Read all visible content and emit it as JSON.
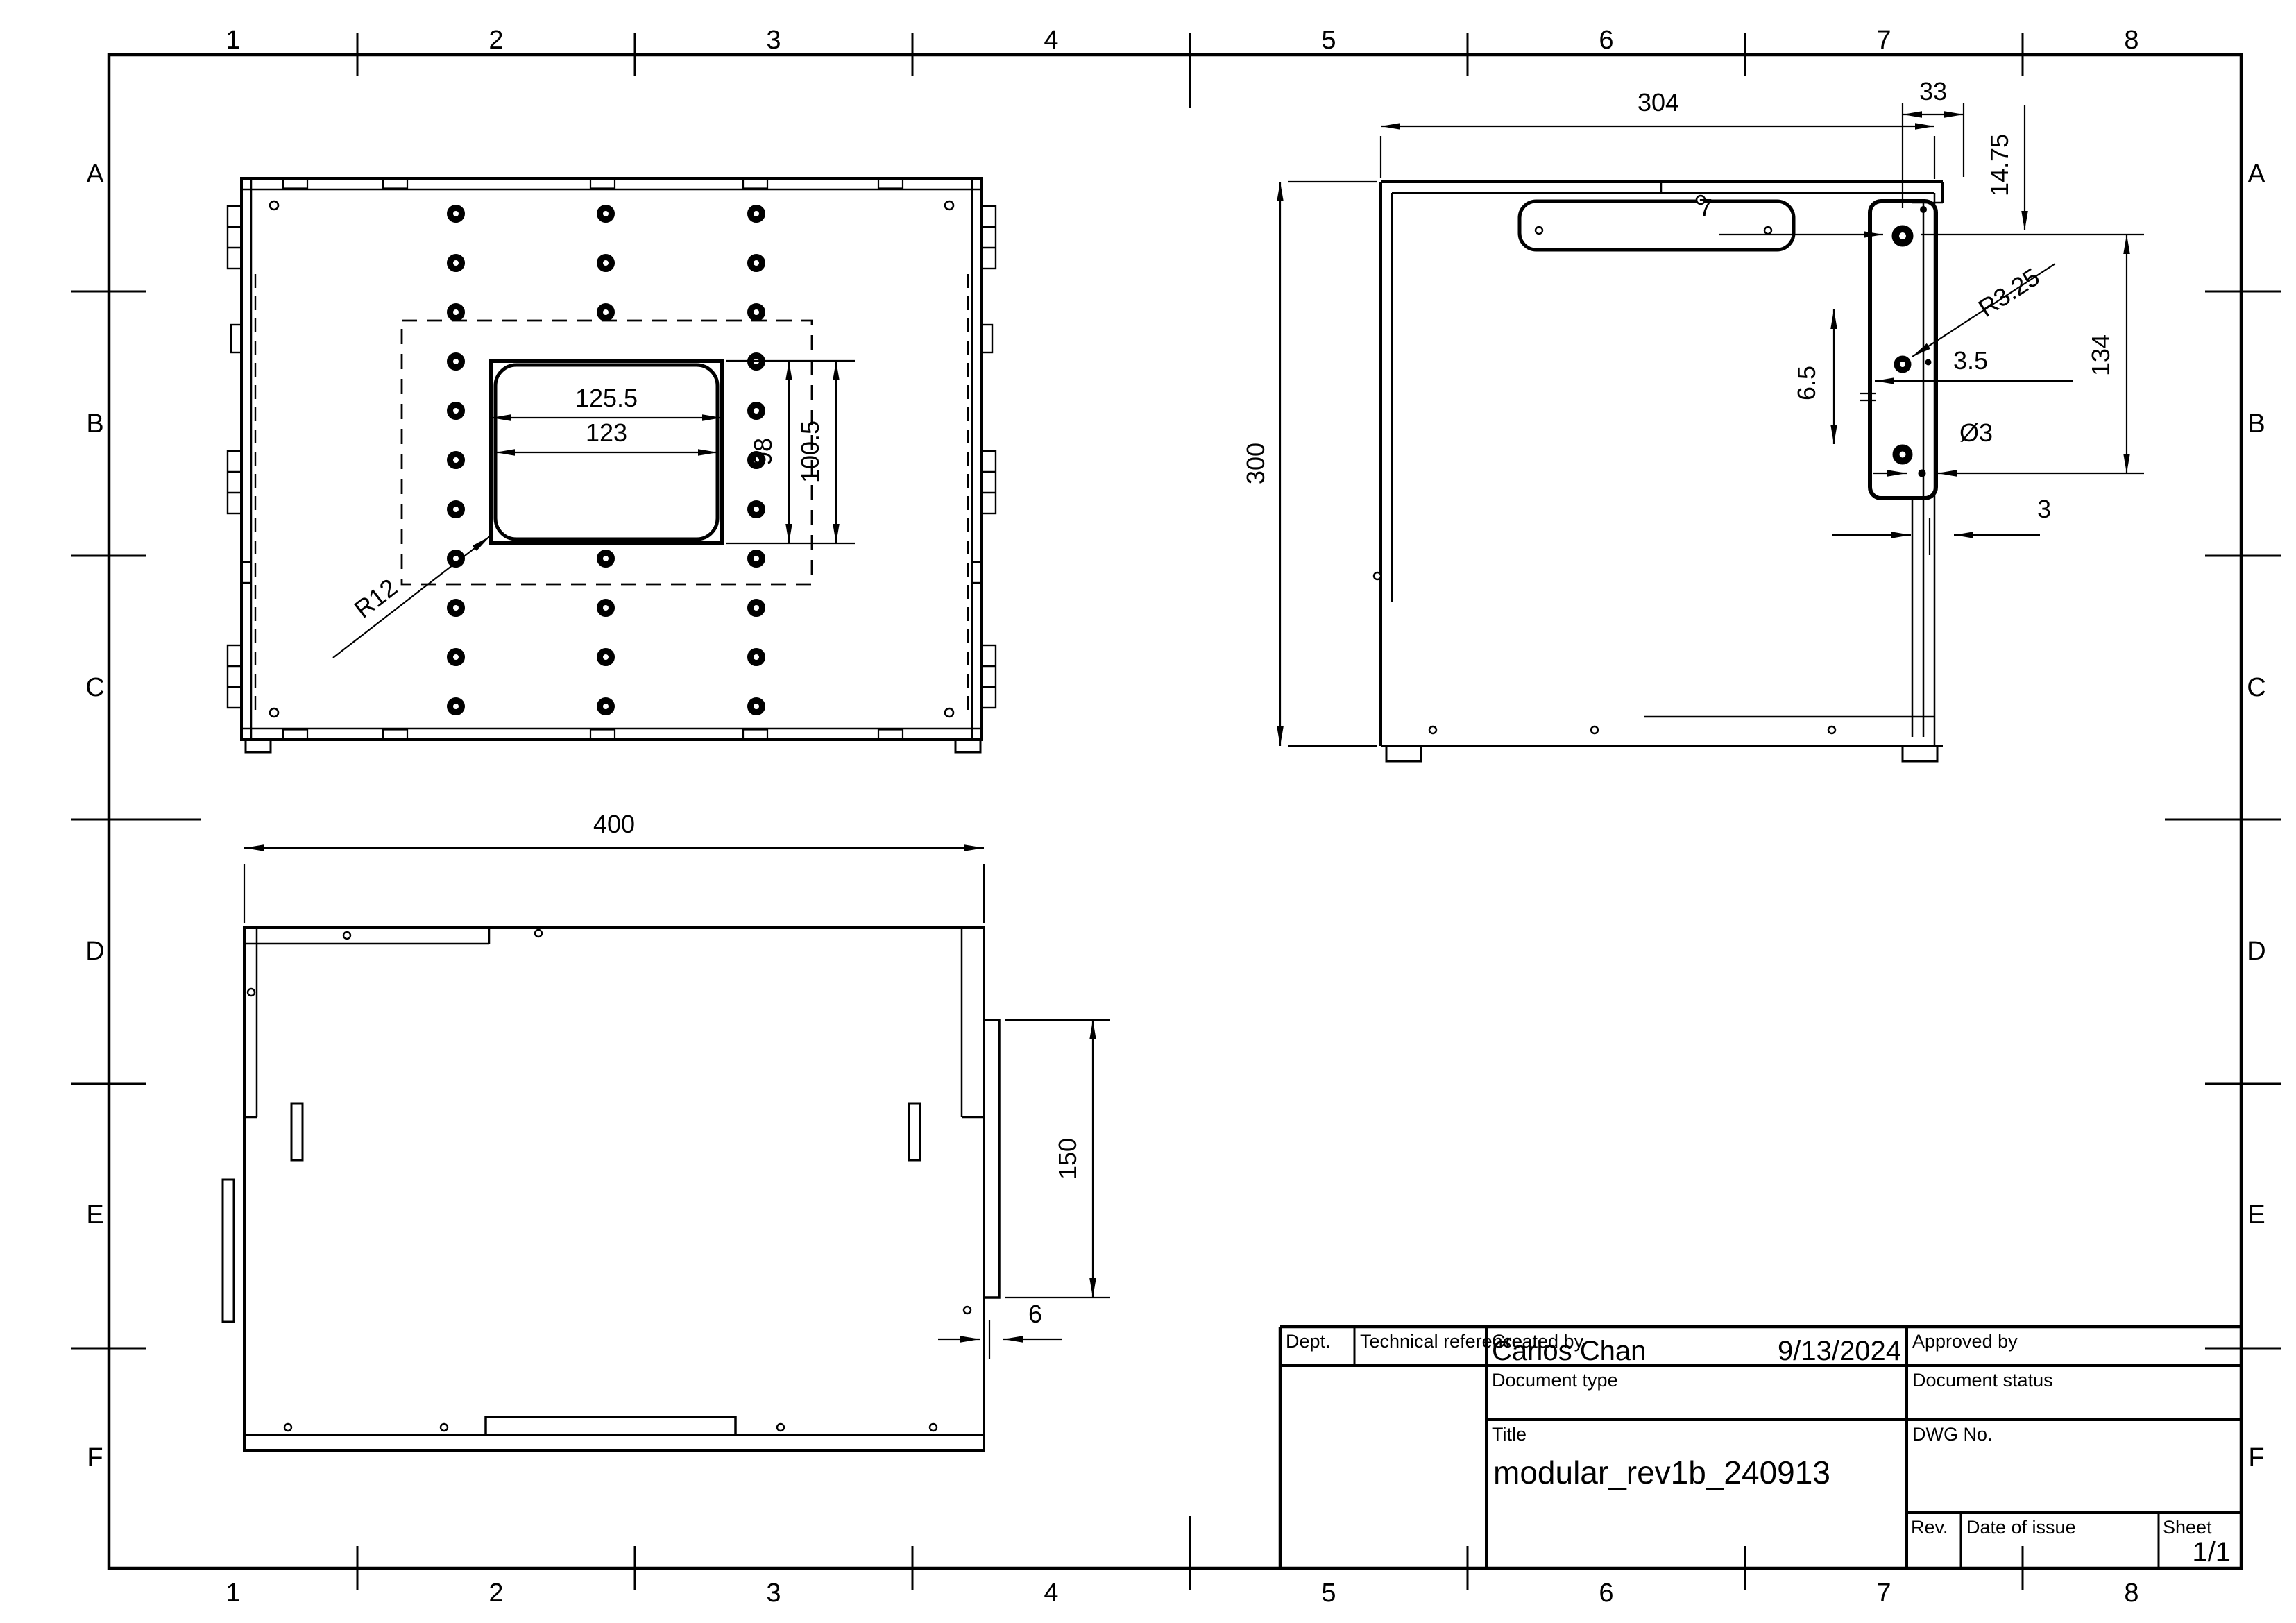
{
  "sheet": {
    "background": "#ffffff",
    "line_color": "#000000",
    "grid_columns": [
      "1",
      "2",
      "3",
      "4",
      "5",
      "6",
      "7",
      "8"
    ],
    "grid_rows": [
      "A",
      "B",
      "C",
      "D",
      "E",
      "F"
    ]
  },
  "top_view": {
    "dim_width_outer": "125.5",
    "dim_width_inner": "123",
    "dim_height_inner": "98",
    "dim_height_outer": "100.5",
    "dim_corner_radius": "R12"
  },
  "side_view": {
    "dim_width": "304",
    "dim_height": "300",
    "dim_tab_width": "33",
    "dim_top_offset": "14.75",
    "dim_hole_offset": "7",
    "dim_slot_radius": "R3.25",
    "dim_hole_gap": "3.5",
    "dim_hole_pitch": "6.5",
    "dim_hole_dia": "Ø3",
    "dim_wall_thickness": "3",
    "dim_bracket_span": "134"
  },
  "bottom_view": {
    "dim_width": "400",
    "dim_flange_height": "150",
    "dim_wall_thickness": "6"
  },
  "title_block": {
    "dept_label": "Dept.",
    "tech_ref_label": "Technical reference",
    "created_by_label": "Created by",
    "created_by_name": "Carlos Chan",
    "created_date": "9/13/2024",
    "approved_by_label": "Approved by",
    "doc_type_label": "Document type",
    "doc_status_label": "Document status",
    "title_label": "Title",
    "title_value": "modular_rev1b_240913",
    "dwg_label": "DWG No.",
    "rev_label": "Rev.",
    "date_of_issue_label": "Date of issue",
    "sheet_label": "Sheet",
    "sheet_value": "1/1"
  }
}
